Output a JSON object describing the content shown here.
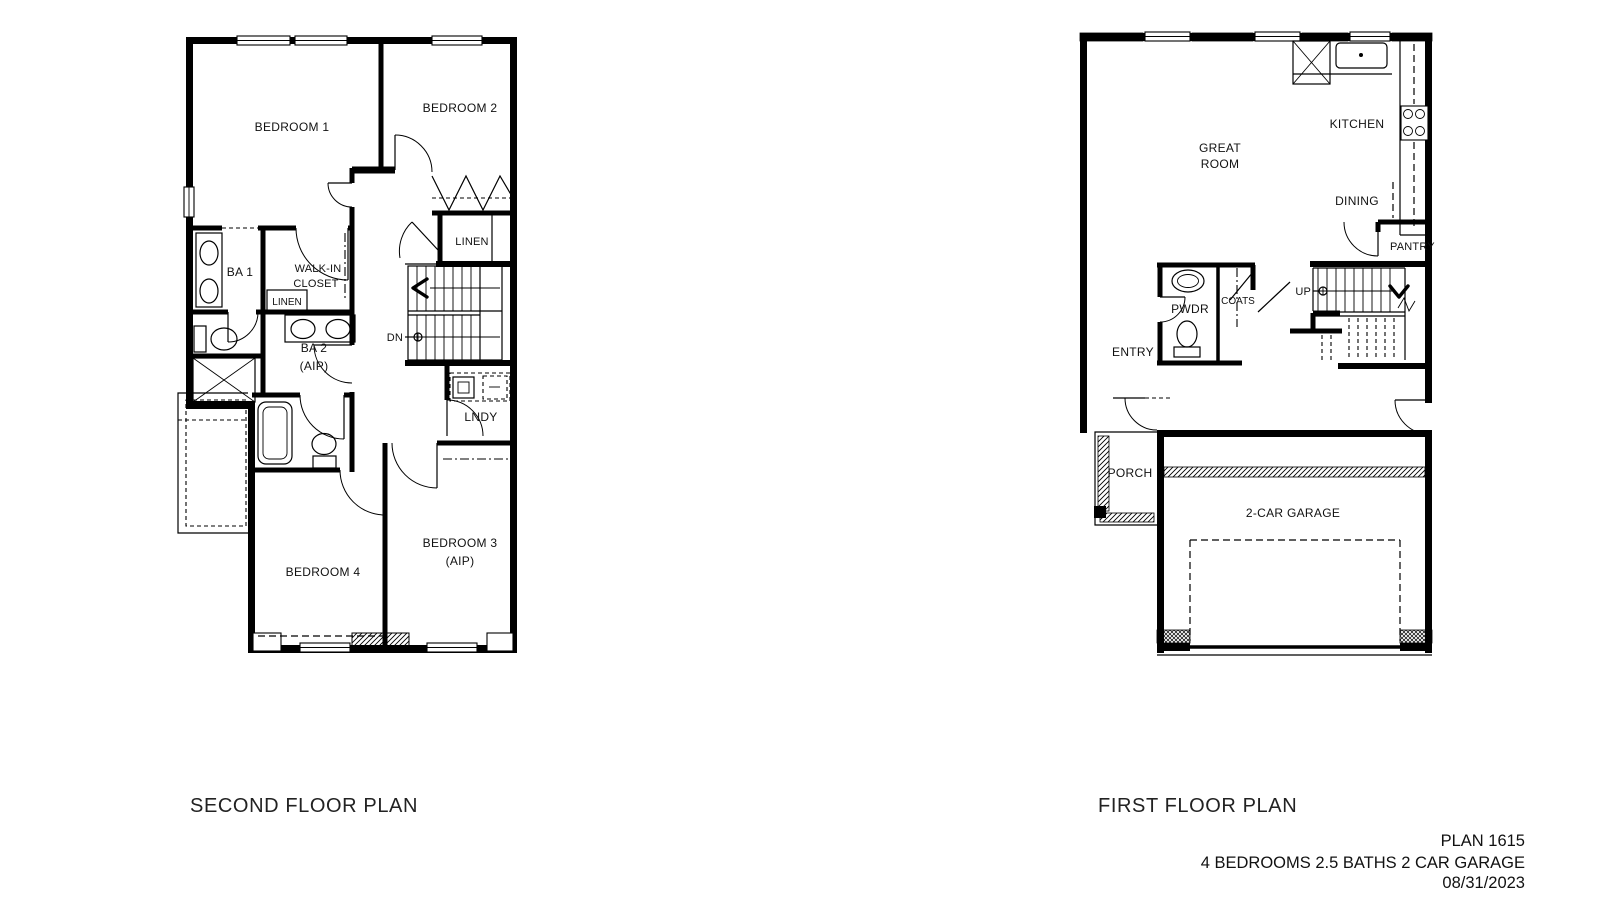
{
  "second_floor": {
    "title": "SECOND FLOOR PLAN",
    "labels": {
      "bedroom1": "BEDROOM 1",
      "bedroom2": "BEDROOM 2",
      "linen_hall": "LINEN",
      "ba1": "BA 1",
      "walkin1": "WALK-IN",
      "walkin2": "CLOSET",
      "linen_small": "LINEN",
      "ba2": "BA 2",
      "ba2_aip": "(AIP)",
      "dn": "DN",
      "lndy": "LNDY",
      "bedroom4": "BEDROOM 4",
      "bedroom3": "BEDROOM 3",
      "bedroom3_aip": "(AIP)"
    }
  },
  "first_floor": {
    "title": "FIRST FLOOR PLAN",
    "labels": {
      "great_room1": "GREAT",
      "great_room2": "ROOM",
      "kitchen": "KITCHEN",
      "dining": "DINING",
      "pantry": "PANTRY",
      "pwdr": "PWDR",
      "coats": "COATS",
      "up": "UP",
      "entry": "ENTRY",
      "porch": "PORCH",
      "garage": "2-CAR GARAGE"
    }
  },
  "title_block": {
    "plan_number": "PLAN 1615",
    "specs": "4 BEDROOMS 2.5 BATHS 2 CAR GARAGE",
    "date": "08/31/2023"
  },
  "colors": {
    "ink": "#000000",
    "paper": "#ffffff"
  }
}
